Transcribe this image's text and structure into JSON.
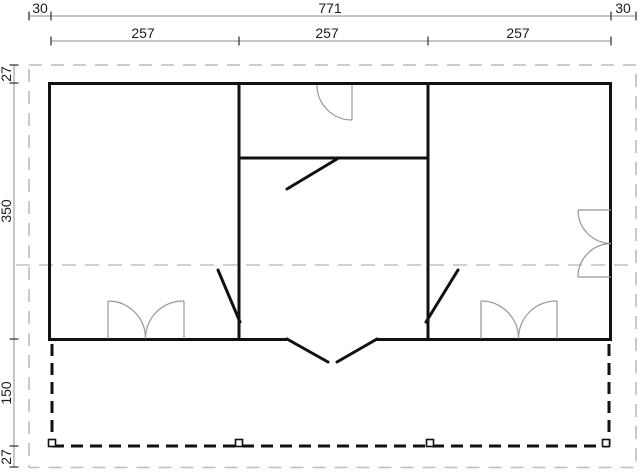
{
  "drawing": {
    "type": "floor-plan",
    "background": "#ffffff",
    "colors": {
      "wall": "#111111",
      "dimension_line": "#8c8c8c",
      "dimension_text": "#1c1c1c",
      "fixture_gray": "#979797",
      "roof_outline_gray": "#bcbcbc"
    },
    "dimensions": {
      "top_row": [
        "30",
        "771",
        "30"
      ],
      "bay_row": [
        "257",
        "257",
        "257"
      ],
      "left_column": [
        "27",
        "350",
        "150",
        "27"
      ]
    }
  }
}
